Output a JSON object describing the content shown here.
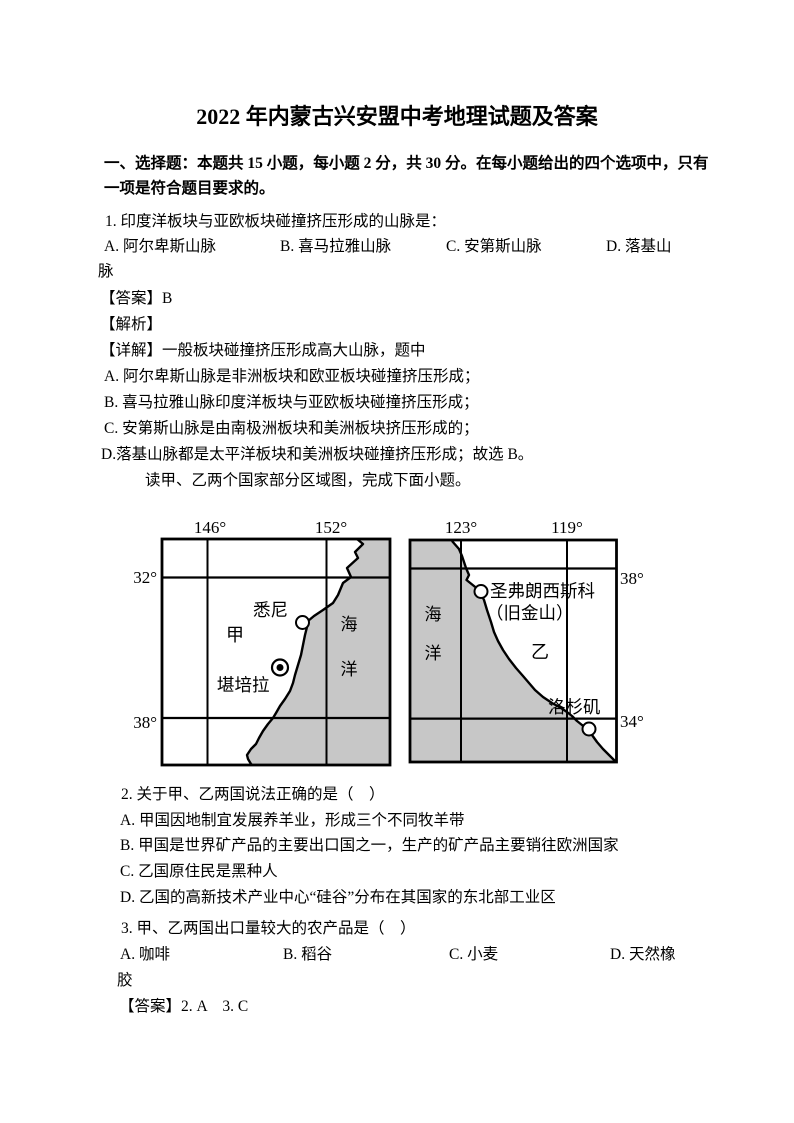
{
  "title": "2022 年内蒙古兴安盟中考地理试题及答案",
  "section": {
    "line1": "一、选择题：本题共 15 小题，每小题 2 分，共 30 分。在每小题给出的四个选项中，只有",
    "line2": "一项是符合题目要求的。"
  },
  "q1": {
    "stem": "1. 印度洋板块与亚欧板块碰撞挤压形成的山脉是：",
    "option_a": "A. 阿尔卑斯山脉",
    "option_b": "B. 喜马拉雅山脉",
    "option_c": "C. 安第斯山脉",
    "option_d": "D. 落基山",
    "option_d_wrap": "脉",
    "answer": "【答案】B",
    "analysis_label": "【解析】",
    "detail_intro": "【详解】一般板块碰撞挤压形成高大山脉，题中",
    "detail_a": "A. 阿尔卑斯山脉是非洲板块和欧亚板块碰撞挤压形成；",
    "detail_b": "B. 喜马拉雅山脉印度洋板块与亚欧板块碰撞挤压形成；",
    "detail_c": "C. 安第斯山脉是由南极洲板块和美洲板块挤压形成的；",
    "detail_d": "D.落基山脉都是太平洋板块和美洲板块碰撞挤压形成；故选 B。"
  },
  "figure_intro": "读甲、乙两个国家部分区域图，完成下面小题。",
  "figure": {
    "ocean_color": "#c7c7c7",
    "line_color": "#000000",
    "map_jia": {
      "lon_left": "146°",
      "lon_right": "152°",
      "lat_top": "32°",
      "lat_bottom": "38°",
      "city_sydney": "悉尼",
      "region_label": "甲",
      "city_canberra": "堪培拉",
      "ocean_char1": "海",
      "ocean_char2": "洋"
    },
    "map_yi": {
      "lon_left": "123°",
      "lon_right": "119°",
      "lat_top": "38°",
      "lat_bottom": "34°",
      "city_sf_line1": "圣弗朗西斯科",
      "city_sf_line2": "（旧金山）",
      "region_label": "乙",
      "city_la": "洛杉矶",
      "ocean_char1": "海",
      "ocean_char2": "洋"
    }
  },
  "q2": {
    "stem": "2. 关于甲、乙两国说法正确的是（　）",
    "option_a": "A. 甲国因地制宜发展养羊业，形成三个不同牧羊带",
    "option_b": "B. 甲国是世界矿产品的主要出口国之一，生产的矿产品主要销往欧洲国家",
    "option_c": "C. 乙国原住民是黑种人",
    "option_d": "D. 乙国的高新技术产业中心“硅谷”分布在其国家的东北部工业区"
  },
  "q3": {
    "stem": "3. 甲、乙两国出口量较大的农产品是（　）",
    "option_a": "A. 咖啡",
    "option_b": "B. 稻谷",
    "option_c": "C. 小麦",
    "option_d": "D. 天然橡",
    "option_d_wrap": "胶"
  },
  "answers_2_3": "【答案】2. A    3. C"
}
